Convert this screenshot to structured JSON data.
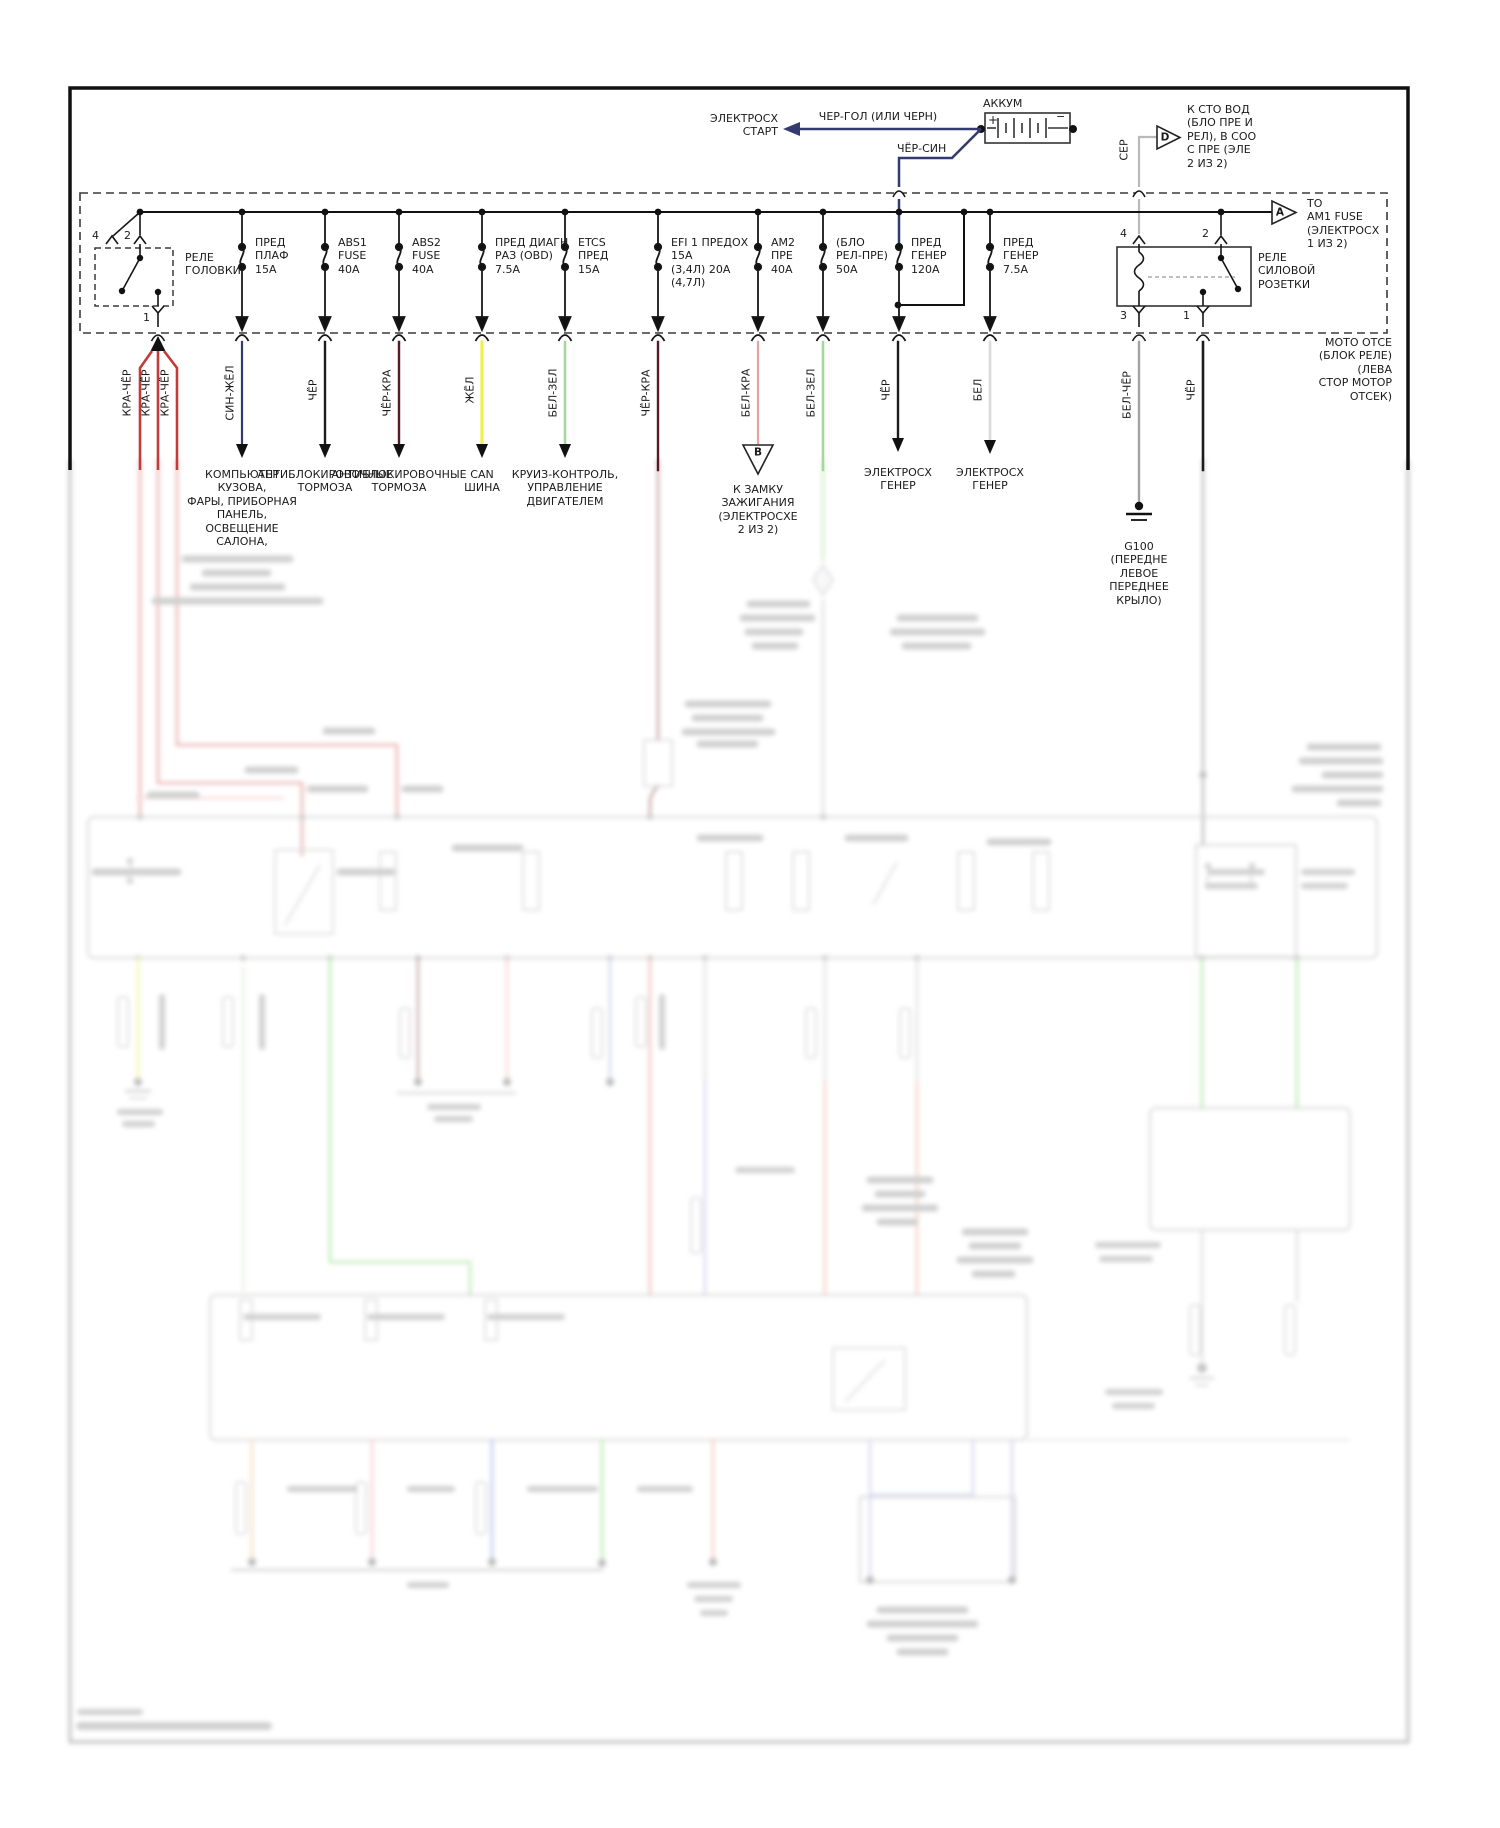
{
  "colors": {
    "navy_wire": "#333a70",
    "red_wire": "#c23b3b",
    "maroon_wire": "#571b24",
    "yellow_wire": "#efef4e",
    "green_wire": "#a6d7a0",
    "pink_wire": "#e8a1a1",
    "black_wire": "#1c1c1c",
    "white_wire": "#dcdcdc",
    "gray_wire": "#a3a3a3",
    "ser_wire": "#b9b9b9",
    "line_ink": "#161616"
  },
  "battery": {
    "label": "АККУМ",
    "plus": "+",
    "minus": "−"
  },
  "start_circuit": {
    "dest": "ЭЛЕКТРОСХ\nСТАРТ",
    "wire": "ЧЕР-ГОЛ (ИЛИ ЧЕРН)",
    "wire2": "ЧЁР-СИН"
  },
  "sto_vod": {
    "letter": "D",
    "label": "К СТО ВОД\n(БЛО ПРЕ И\nРЕЛ), В СОО\nС ПРЕ (ЭЛЕ\n2 ИЗ 2)",
    "wire": "СЕР"
  },
  "am1": {
    "letter": "A",
    "label": "TO\nAM1 FUSE\n(ЭЛЕКТРОСХ\n1 ИЗ 2)"
  },
  "box_note": "МОТО ОТСЕ\n(БЛОК РЕЛЕ)\n(ЛЕВА\nСТОР МОТОР\nОТСЕК)",
  "head_relay": {
    "label": "РЕЛЕ\nГОЛОВКИ",
    "pin4": "4",
    "pin2": "2",
    "pin1": "1"
  },
  "outlet_relay": {
    "label": "РЕЛЕ\nСИЛОВОЙ\nРОЗЕТКИ",
    "pin4": "4",
    "pin2": "2",
    "pin3": "3",
    "pin1": "1"
  },
  "fuses": {
    "f1": "ПРЕД\nПЛАФ\n15A",
    "f2": "ABS1\nFUSE\n40A",
    "f3": "ABS2\nFUSE\n40A",
    "f4": "ПРЕД ДИАГН\nРАЗ (OBD)\n7.5A",
    "f5": "ETCS\nПРЕД\n15A",
    "f6": "EFI 1 ПРЕДОХ\n15A\n(3,4Л) 20A\n(4,7Л)",
    "f7": "АМ2\nПРЕ\n40A",
    "f8": "(БЛО\nРЕЛ-ПРЕ)\n50A",
    "f9": "ПРЕД\nГЕНЕР\n120A",
    "f10": "ПРЕД\nГЕНЕР\n7.5A"
  },
  "wires": {
    "w1": "КРА-ЧЁР",
    "w2": "КРА-ЧЁР",
    "w3": "КРА-ЧЁР",
    "w4": "СИН-ЖЁЛ",
    "w5": "ЧЁР",
    "w6": "ЧЁР-КРА",
    "w7": "ЖЁЛ",
    "w8": "БЕЛ-ЗЕЛ",
    "w9": "ЧЁР-КРА",
    "w10": "БЕЛ-КРА",
    "w11": "БЕЛ-ЗЕЛ",
    "w12": "ЧЁР",
    "w13": "БЕЛ",
    "w14": "БЕЛ-ЧЁР",
    "w15": "ЧЁР"
  },
  "dest": {
    "body": "КОМПЬЮТЕР\nКУЗОВА,\nФАРЫ, ПРИБОРНАЯ\nПАНЕЛЬ,\nОСВЕЩЕНИЕ\nСАЛОНА,",
    "abs1": "АНТИБЛОКИРОВОЧНЫЕ\nТОРМОЗА",
    "abs2": "АНТИБЛОКИРОВОЧНЫЕ\nТОРМОЗА",
    "can": "CAN\nШИНА",
    "cruise": "КРУИЗ-КОНТРОЛЬ,\nУПРАВЛЕНИЕ\nДВИГАТЕЛЕМ",
    "ignition_letter": "B",
    "ignition": "К ЗАМКУ\nЗАЖИГАНИЯ\n(ЭЛЕКТРОСХЕ\n2 ИЗ 2)",
    "gen1": "ЭЛЕКТРОСХ\nГЕНЕР",
    "gen2": "ЭЛЕКТРОСХ\nГЕНЕР",
    "g100": "G100\n(ПЕРЕДНЕ\nЛЕВОЕ\nПЕРЕДНЕЕ\nКРЫЛО)"
  }
}
